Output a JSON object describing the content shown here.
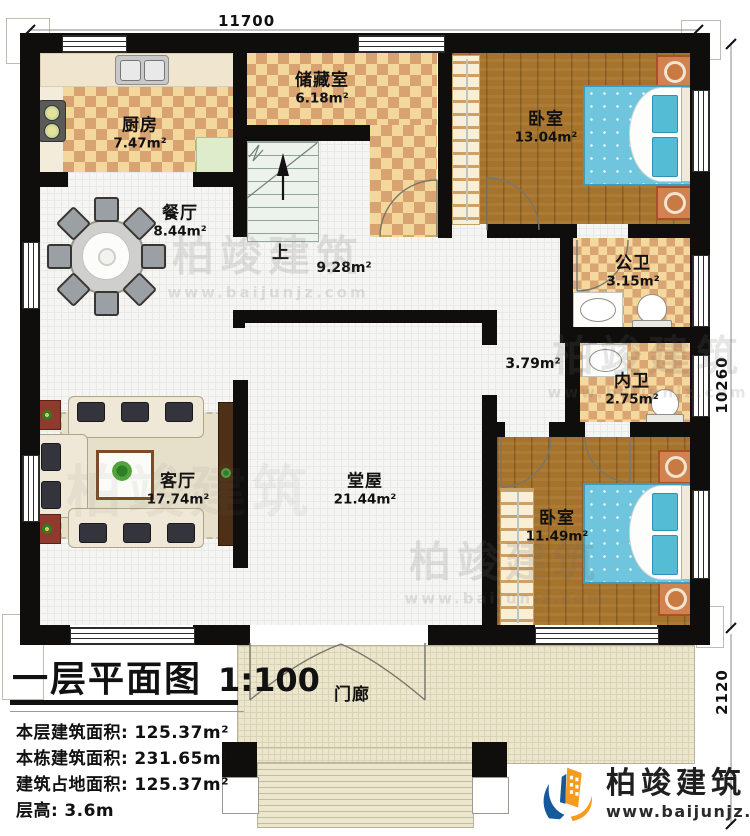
{
  "plan": {
    "title": "一层平面图",
    "scale": "1:100",
    "stats": [
      {
        "label": "本层建筑面积:",
        "value": "125.37m²"
      },
      {
        "label": "本栋建筑面积:",
        "value": "231.65m²"
      },
      {
        "label": "建筑占地面积:",
        "value": "125.37m²"
      },
      {
        "label": "层高:",
        "value": "3.6m"
      }
    ]
  },
  "dimensions": {
    "top": "11700",
    "right": "10260",
    "bottom_right": "2120"
  },
  "rooms": {
    "kitchen": {
      "name": "厨房",
      "area": "7.47m²"
    },
    "dining": {
      "name": "餐厅",
      "area": "8.44m²"
    },
    "storage": {
      "name": "储藏室",
      "area": "6.18m²"
    },
    "bedroom_top": {
      "name": "卧室",
      "area": "13.04m²"
    },
    "public_bath": {
      "name": "公卫",
      "area": "3.15m²"
    },
    "ensuite_bath": {
      "name": "内卫",
      "area": "2.75m²"
    },
    "living": {
      "name": "客厅",
      "area": "17.74m²"
    },
    "hall": {
      "name": "堂屋",
      "area": "21.44m²"
    },
    "bedroom_bottom": {
      "name": "卧室",
      "area": "11.49m²"
    },
    "porch": {
      "name": "门廊"
    },
    "stair": {
      "up": "上",
      "area": "9.28m²"
    },
    "corridor": {
      "area": "3.79m²"
    }
  },
  "brand": {
    "name": "柏竣建筑",
    "url": "www.baijunjz.com"
  },
  "watermark": {
    "name": "柏竣建筑",
    "url": "www.baijunjz.com"
  },
  "colors": {
    "wall": "#0f0e0c",
    "wood": "#a6732c",
    "checker_dark": "#d8a370",
    "checker_light": "#f4d79b",
    "bed_blue": "#6fc5dd",
    "logo_orange": "#f79b1e",
    "logo_blue": "#15589c"
  }
}
